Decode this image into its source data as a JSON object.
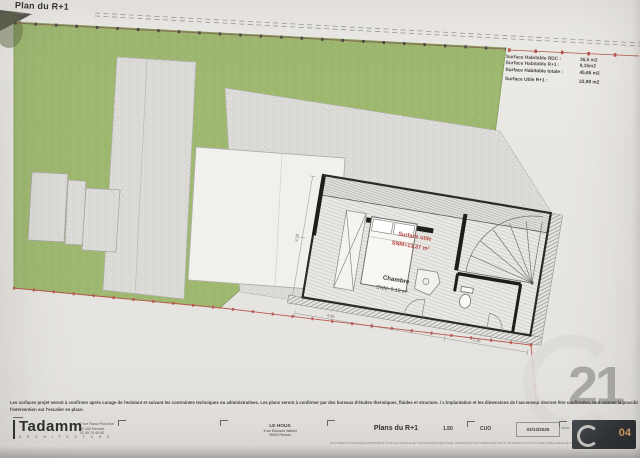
{
  "title": "Plan du R+1",
  "colors": {
    "paper": "#e9e7e3",
    "garden_green": "#9eb870",
    "boundary_red": "#b5524a",
    "annotation_red": "#b5433c",
    "wall_black": "#2b2a28",
    "sheet_number_orange": "#d29a5e"
  },
  "surfaces": {
    "rows": [
      {
        "label": "Surface Habitable  RDC :",
        "value": "36,5 m2"
      },
      {
        "label": "Surface Habitable  R+1 :",
        "value": "9,15m2"
      },
      {
        "label": "Surface Habitable totale :",
        "value": "45,65 m2"
      },
      {
        "label": "Surface Utile R+1 :",
        "value": "33,98 m2"
      }
    ]
  },
  "plan": {
    "room_label": "Chambre",
    "room_area": "SNM: 9,18 m²",
    "red_note_line1": "Surface utile",
    "red_note_line2": "SNM=13,37 m²",
    "dim_bottom_a": "4,56",
    "dim_bottom_b": "2,35",
    "dim_left": "4,58"
  },
  "notes": {
    "line1": "Les surfaces projet seront à confirmer après curage de l'existant et suivant les contraintes techniques ou administratives. Les plans seront à confirmer par des bureaux d'études thermiques, fluides et structure. / L'implantation et les dimensions de l'ascenseur devront être confirmées, tout comme la possibilité technique de",
    "line2": "l'intervention sur l'escalier en place."
  },
  "titleblock": {
    "logo": "Tadamm",
    "logo_sub": "A R C H I T E C T U R E",
    "arch_address1": "2 rue Raoul Ponchon",
    "arch_address2": "35 400 Rennes",
    "arch_address3": "02 99 79 45 80",
    "client_name": "LE HOUX",
    "client_address1": "3 rue Édouard Vaillant",
    "client_address2": "35000 Rennes",
    "doc_title": "Plans du  R+1",
    "disclaimer": "DOCUMENT GRAPHIQUE PROPRIÉTÉ INTELLECTUELLE DE TADAMM ARCHITECTURE, REPRODUCTION MÊME PARTIELLE INTERDITE SANS ACCORD PRÉALABLE DE TADAMM ARCHITECTURE",
    "scale": "1.50",
    "code": "CUO",
    "date": "03/12/2025",
    "indice_label": "indice",
    "sheet_number": "04"
  },
  "watermark": {
    "number": "21"
  }
}
